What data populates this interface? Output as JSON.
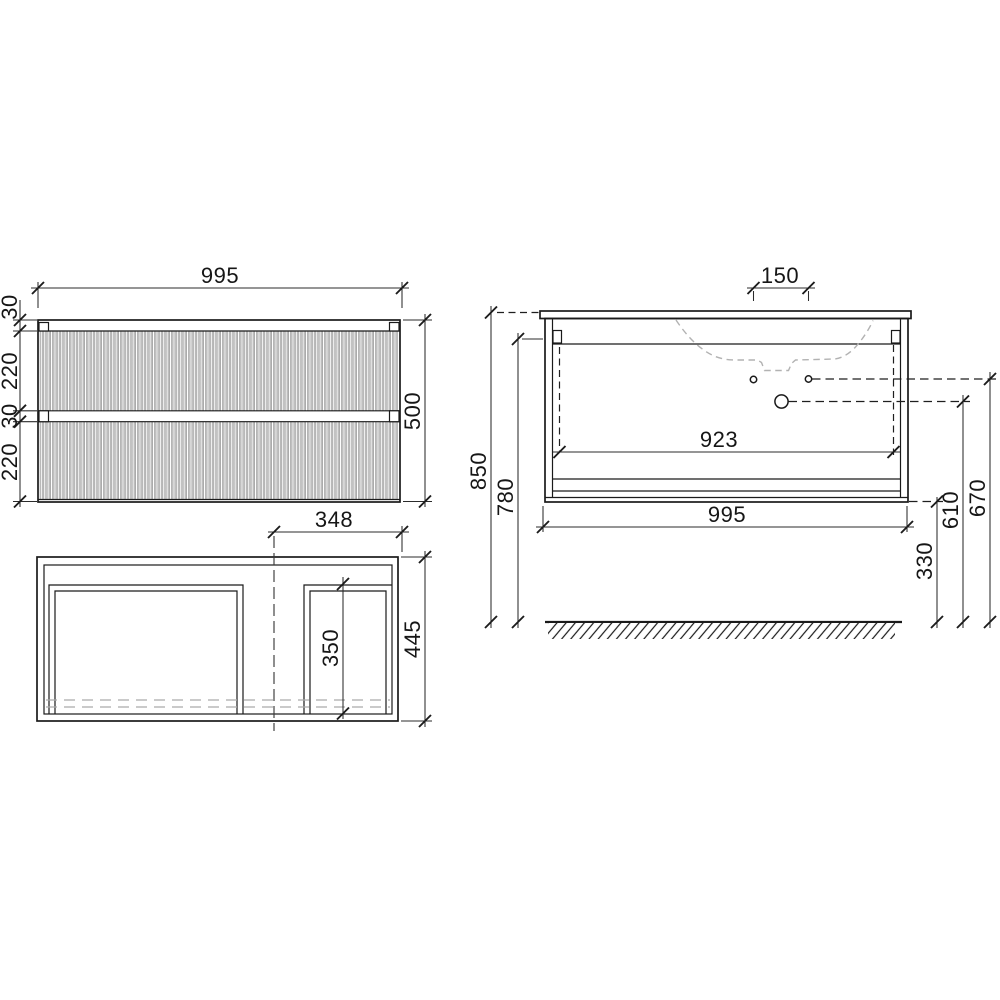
{
  "front_view": {
    "dim_width": "995",
    "dim_height": "500",
    "dim_top_rail": "30",
    "dim_drawer_upper": "220",
    "dim_mid_rail": "30",
    "dim_drawer_lower": "220"
  },
  "plan_view": {
    "dim_offset_right": "348",
    "dim_depth": "445",
    "dim_drawer_depth": "350"
  },
  "side_view": {
    "dim_faucet_spacing": "150",
    "dim_interior_width": "923",
    "dim_width": "995",
    "dim_height_worktop": "850",
    "dim_height_underside": "780",
    "dim_hole_upper": "670",
    "dim_hole_lower": "610",
    "dim_clearance": "330"
  },
  "colors": {
    "line": "#1a1a1a",
    "flute_gray": "#8d8d8d",
    "ghost": "#b2b2b2"
  }
}
